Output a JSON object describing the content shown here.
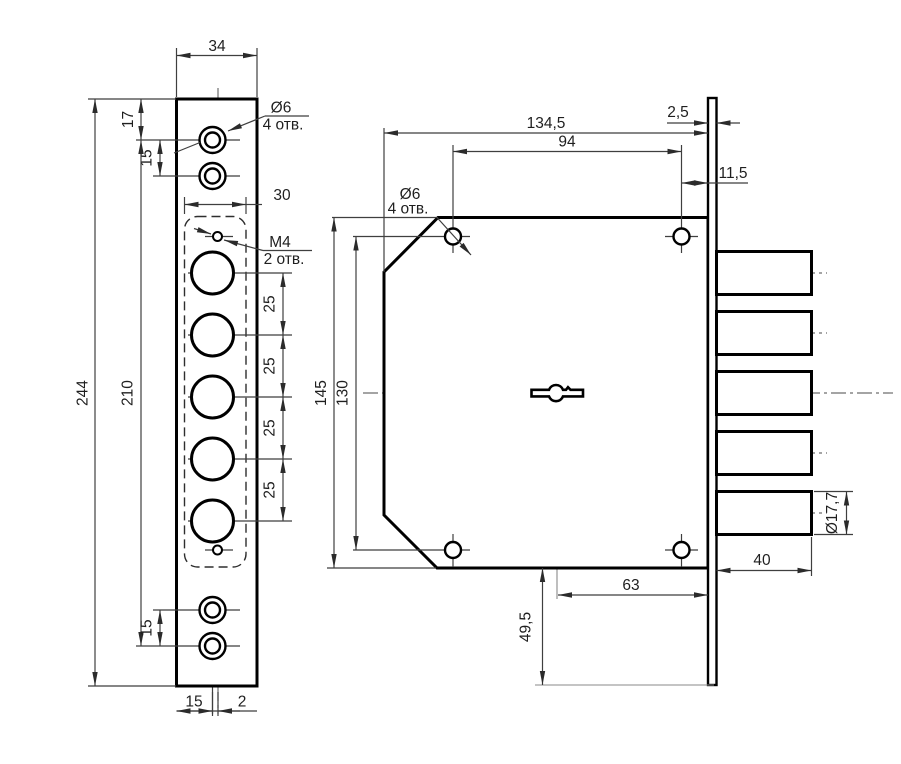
{
  "drawing": {
    "front": {
      "width": "34",
      "hole_top": "17",
      "pitch": "15",
      "height": "244",
      "span": "210",
      "circle_pitch": "25",
      "body_width": "30",
      "edge_to_axis": "15",
      "axis_offset": "2",
      "hole_dia": "Ø6",
      "hole_qty": "4 отв.",
      "thread": "M4",
      "thread_qty": "2 отв."
    },
    "side": {
      "length": "134,5",
      "hole_span": "94",
      "plate_t": "2,5",
      "hole_to_plate": "11,5",
      "height": "145",
      "hole_span_v": "130",
      "key_to_plate_end": "49,5",
      "key_to_edge": "63",
      "bolt_len": "40",
      "bolt_dia": "Ø17,7",
      "hole_dia": "Ø6",
      "hole_qty": "4 отв."
    }
  }
}
